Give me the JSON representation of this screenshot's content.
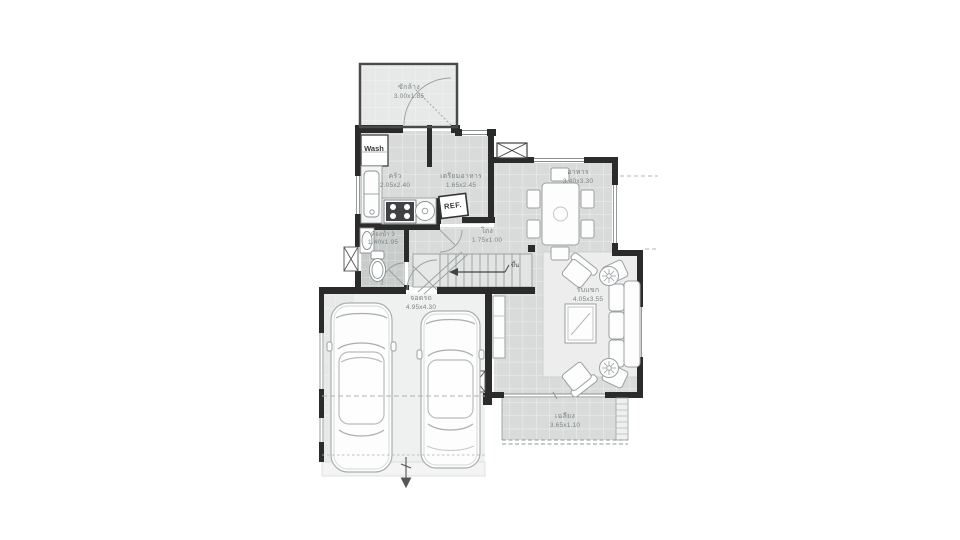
{
  "plan": {
    "rooms": [
      {
        "id": "laundry",
        "label": "ซักล้าง",
        "dims": "3.00x1.85"
      },
      {
        "id": "kitchen",
        "label": "ครัว",
        "dims": "2.05x2.40"
      },
      {
        "id": "prep",
        "label": "เตรียมอาหาร",
        "dims": "1.65x2.45"
      },
      {
        "id": "dining",
        "label": "อาหาร",
        "dims": "3.40x3.30"
      },
      {
        "id": "living",
        "label": "รับแขก",
        "dims": "4.05x3.55"
      },
      {
        "id": "bathroom",
        "label": "ห้องน้ำ 3",
        "dims": "1.40x1.95"
      },
      {
        "id": "hall",
        "label": "โถง",
        "dims": "1.75x1.00"
      },
      {
        "id": "garage",
        "label": "จอดรถ",
        "dims": "4.95x4.30"
      },
      {
        "id": "porch",
        "label": "เฉลียง",
        "dims": "3.65x1.10"
      }
    ],
    "fixtures": {
      "washer": "Wash",
      "refrigerator": "REF.",
      "stairs_up": "ขึ้น"
    },
    "colors": {
      "wall": "#2b2b2b",
      "floor_tile": "#d9dbda",
      "floor_light": "#e7e9e8",
      "bath_tile": "#c7cbca",
      "garage_floor": "#eff1f0",
      "rug": "#ecedec",
      "label_text": "#7d8386",
      "furniture_stroke": "#9aa0a2"
    }
  }
}
